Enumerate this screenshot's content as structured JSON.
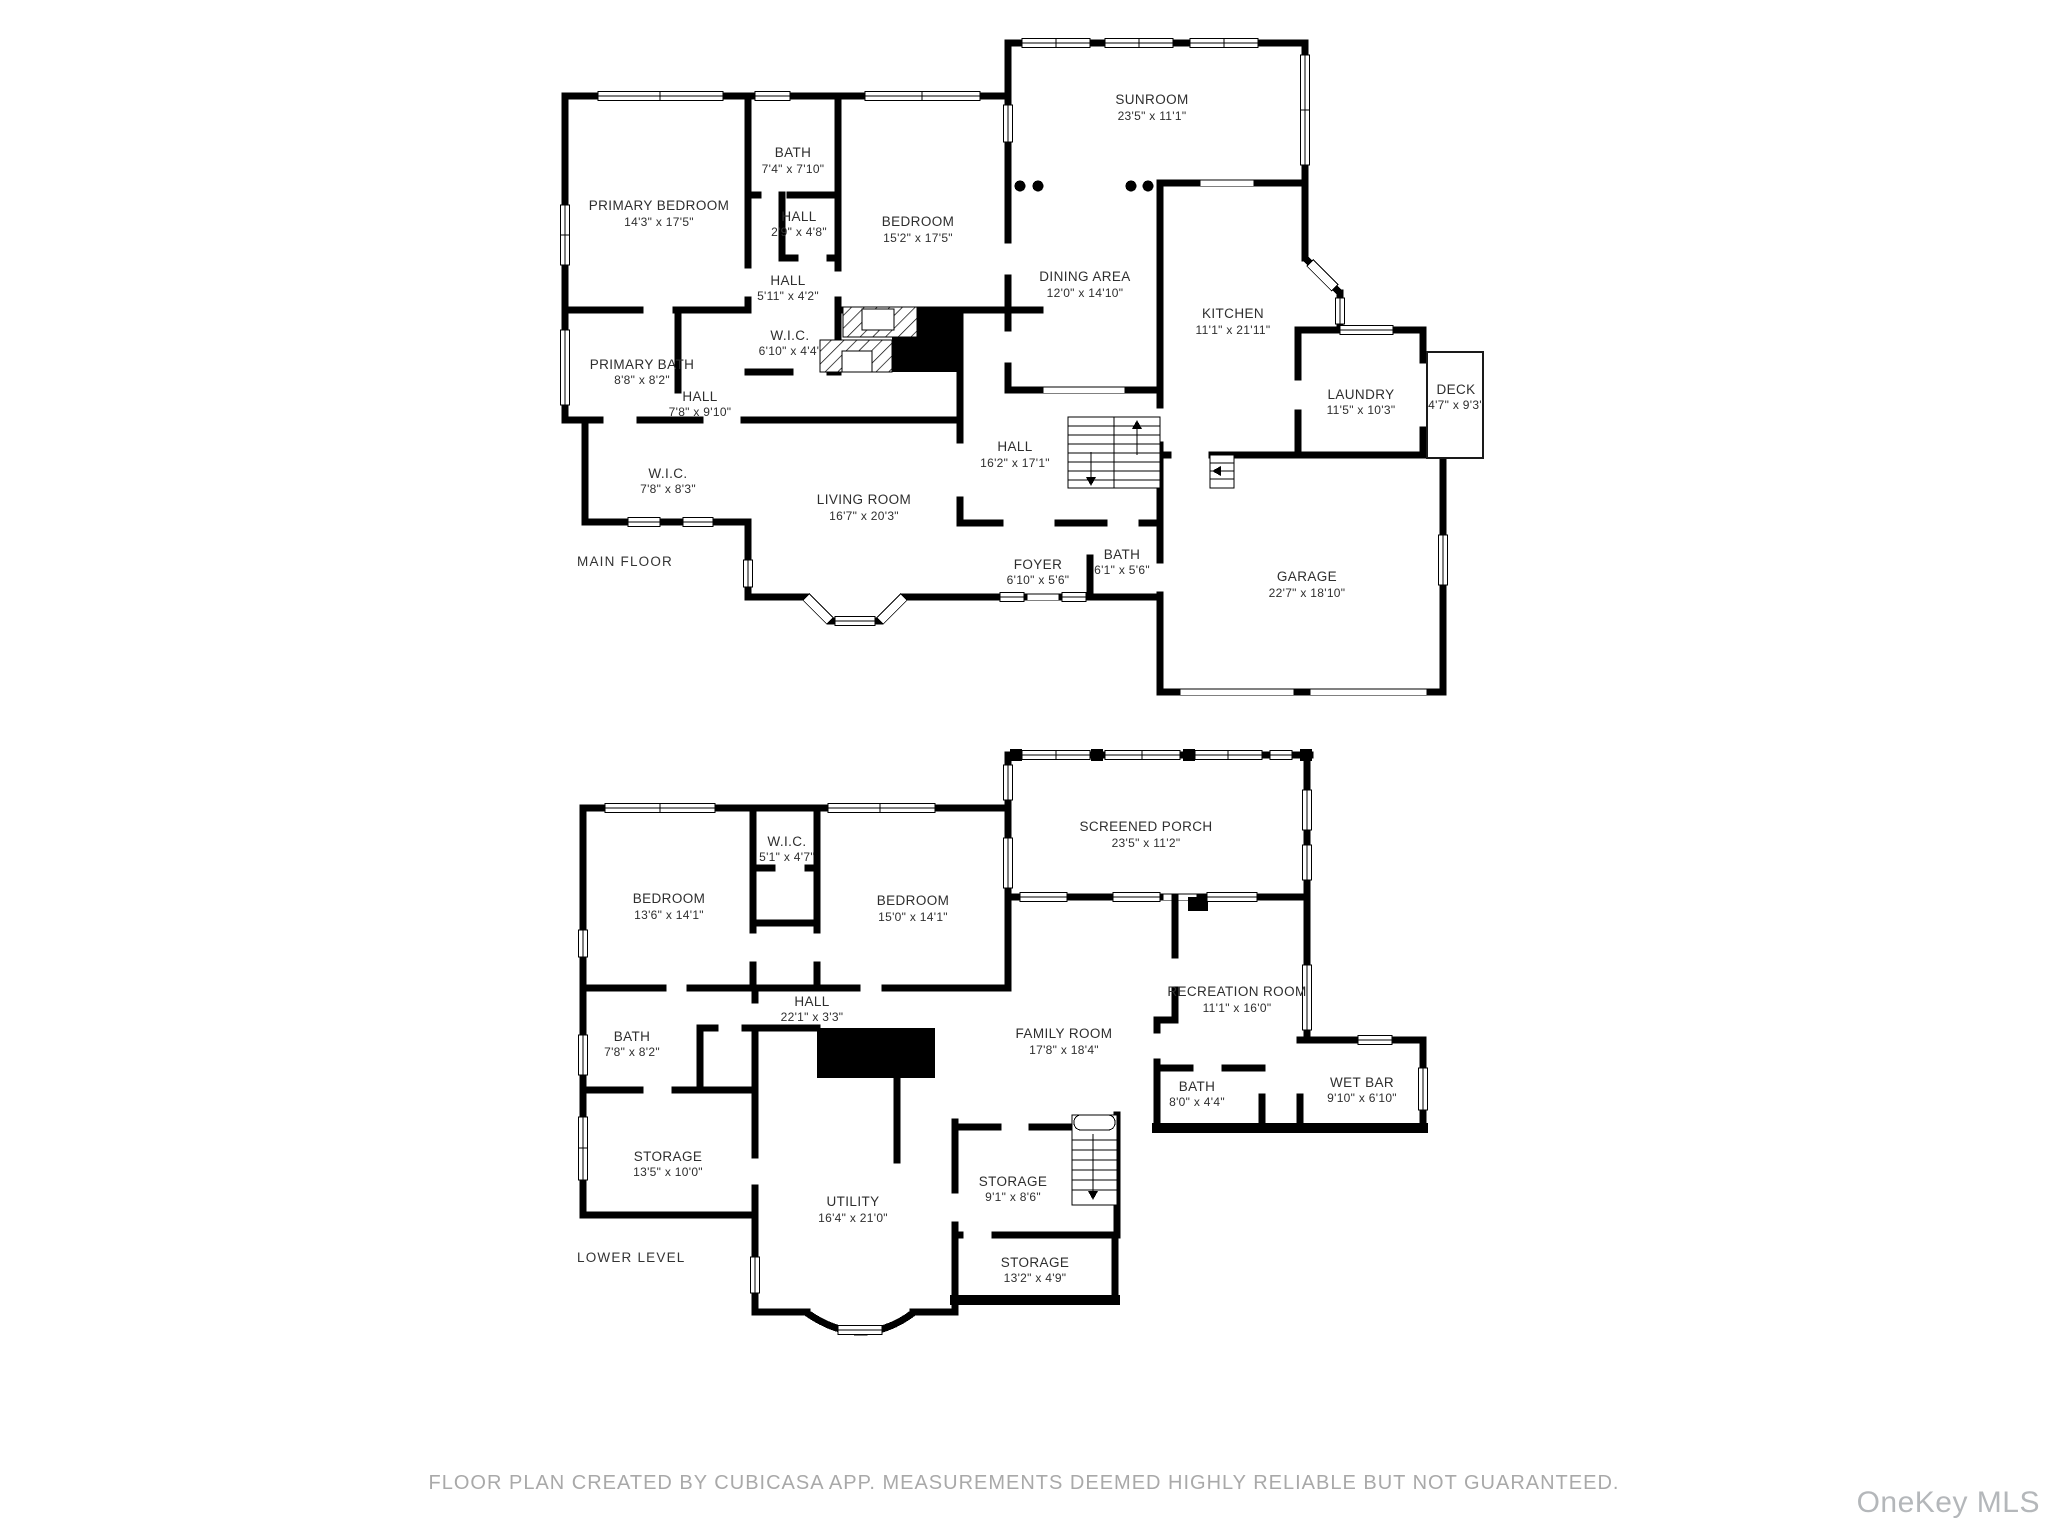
{
  "floors": [
    {
      "title": "MAIN FLOOR",
      "rooms": [
        {
          "name": "PRIMARY BEDROOM",
          "dims": "14'3\" x 17'5\""
        },
        {
          "name": "BATH",
          "dims": "7'4\" x 7'10\""
        },
        {
          "name": "HALL",
          "dims": "2'9\" x 4'8\""
        },
        {
          "name": "BEDROOM",
          "dims": "15'2\" x 17'5\""
        },
        {
          "name": "HALL",
          "dims": "5'11\" x 4'2\""
        },
        {
          "name": "SUNROOM",
          "dims": "23'5\" x 11'1\""
        },
        {
          "name": "DINING AREA",
          "dims": "12'0\" x 14'10\""
        },
        {
          "name": "KITCHEN",
          "dims": "11'1\" x 21'11\""
        },
        {
          "name": "LAUNDRY",
          "dims": "11'5\" x 10'3\""
        },
        {
          "name": "DECK",
          "dims": "4'7\" x 9'3\""
        },
        {
          "name": "W.I.C.",
          "dims": "6'10\" x 4'4\""
        },
        {
          "name": "PRIMARY BATH",
          "dims": "8'8\" x 8'2\""
        },
        {
          "name": "HALL",
          "dims": "7'8\" x 9'10\""
        },
        {
          "name": "W.I.C.",
          "dims": "7'8\" x 8'3\""
        },
        {
          "name": "LIVING ROOM",
          "dims": "16'7\" x 20'3\""
        },
        {
          "name": "HALL",
          "dims": "16'2\" x 17'1\""
        },
        {
          "name": "FOYER",
          "dims": "6'10\" x 5'6\""
        },
        {
          "name": "BATH",
          "dims": "6'1\" x 5'6\""
        },
        {
          "name": "GARAGE",
          "dims": "22'7\" x 18'10\""
        }
      ]
    },
    {
      "title": "LOWER LEVEL",
      "rooms": [
        {
          "name": "BEDROOM",
          "dims": "13'6\" x 14'1\""
        },
        {
          "name": "W.I.C.",
          "dims": "5'1\" x 4'7\""
        },
        {
          "name": "BEDROOM",
          "dims": "15'0\" x 14'1\""
        },
        {
          "name": "SCREENED PORCH",
          "dims": "23'5\" x 11'2\""
        },
        {
          "name": "HALL",
          "dims": "22'1\" x 3'3\""
        },
        {
          "name": "BATH",
          "dims": "7'8\" x 8'2\""
        },
        {
          "name": "FAMILY ROOM",
          "dims": "17'8\" x 18'4\""
        },
        {
          "name": "RECREATION ROOM",
          "dims": "11'1\" x 16'0\""
        },
        {
          "name": "BATH",
          "dims": "8'0\" x 4'4\""
        },
        {
          "name": "WET BAR",
          "dims": "9'10\" x 6'10\""
        },
        {
          "name": "STORAGE",
          "dims": "13'5\" x 10'0\""
        },
        {
          "name": "UTILITY",
          "dims": "16'4\" x 21'0\""
        },
        {
          "name": "STORAGE",
          "dims": "9'1\" x 8'6\""
        },
        {
          "name": "STORAGE",
          "dims": "13'2\" x 4'9\""
        }
      ]
    }
  ],
  "footer": {
    "disclaimer": "FLOOR PLAN CREATED BY CUBICASA APP. MEASUREMENTS DEEMED HIGHLY RELIABLE BUT NOT GUARANTEED."
  },
  "watermark": "OneKey MLS",
  "colors": {
    "wall": "#000000",
    "label": "#2e2e2e",
    "footer": "#a9a9a9",
    "watermark": "#b4b7ba"
  }
}
